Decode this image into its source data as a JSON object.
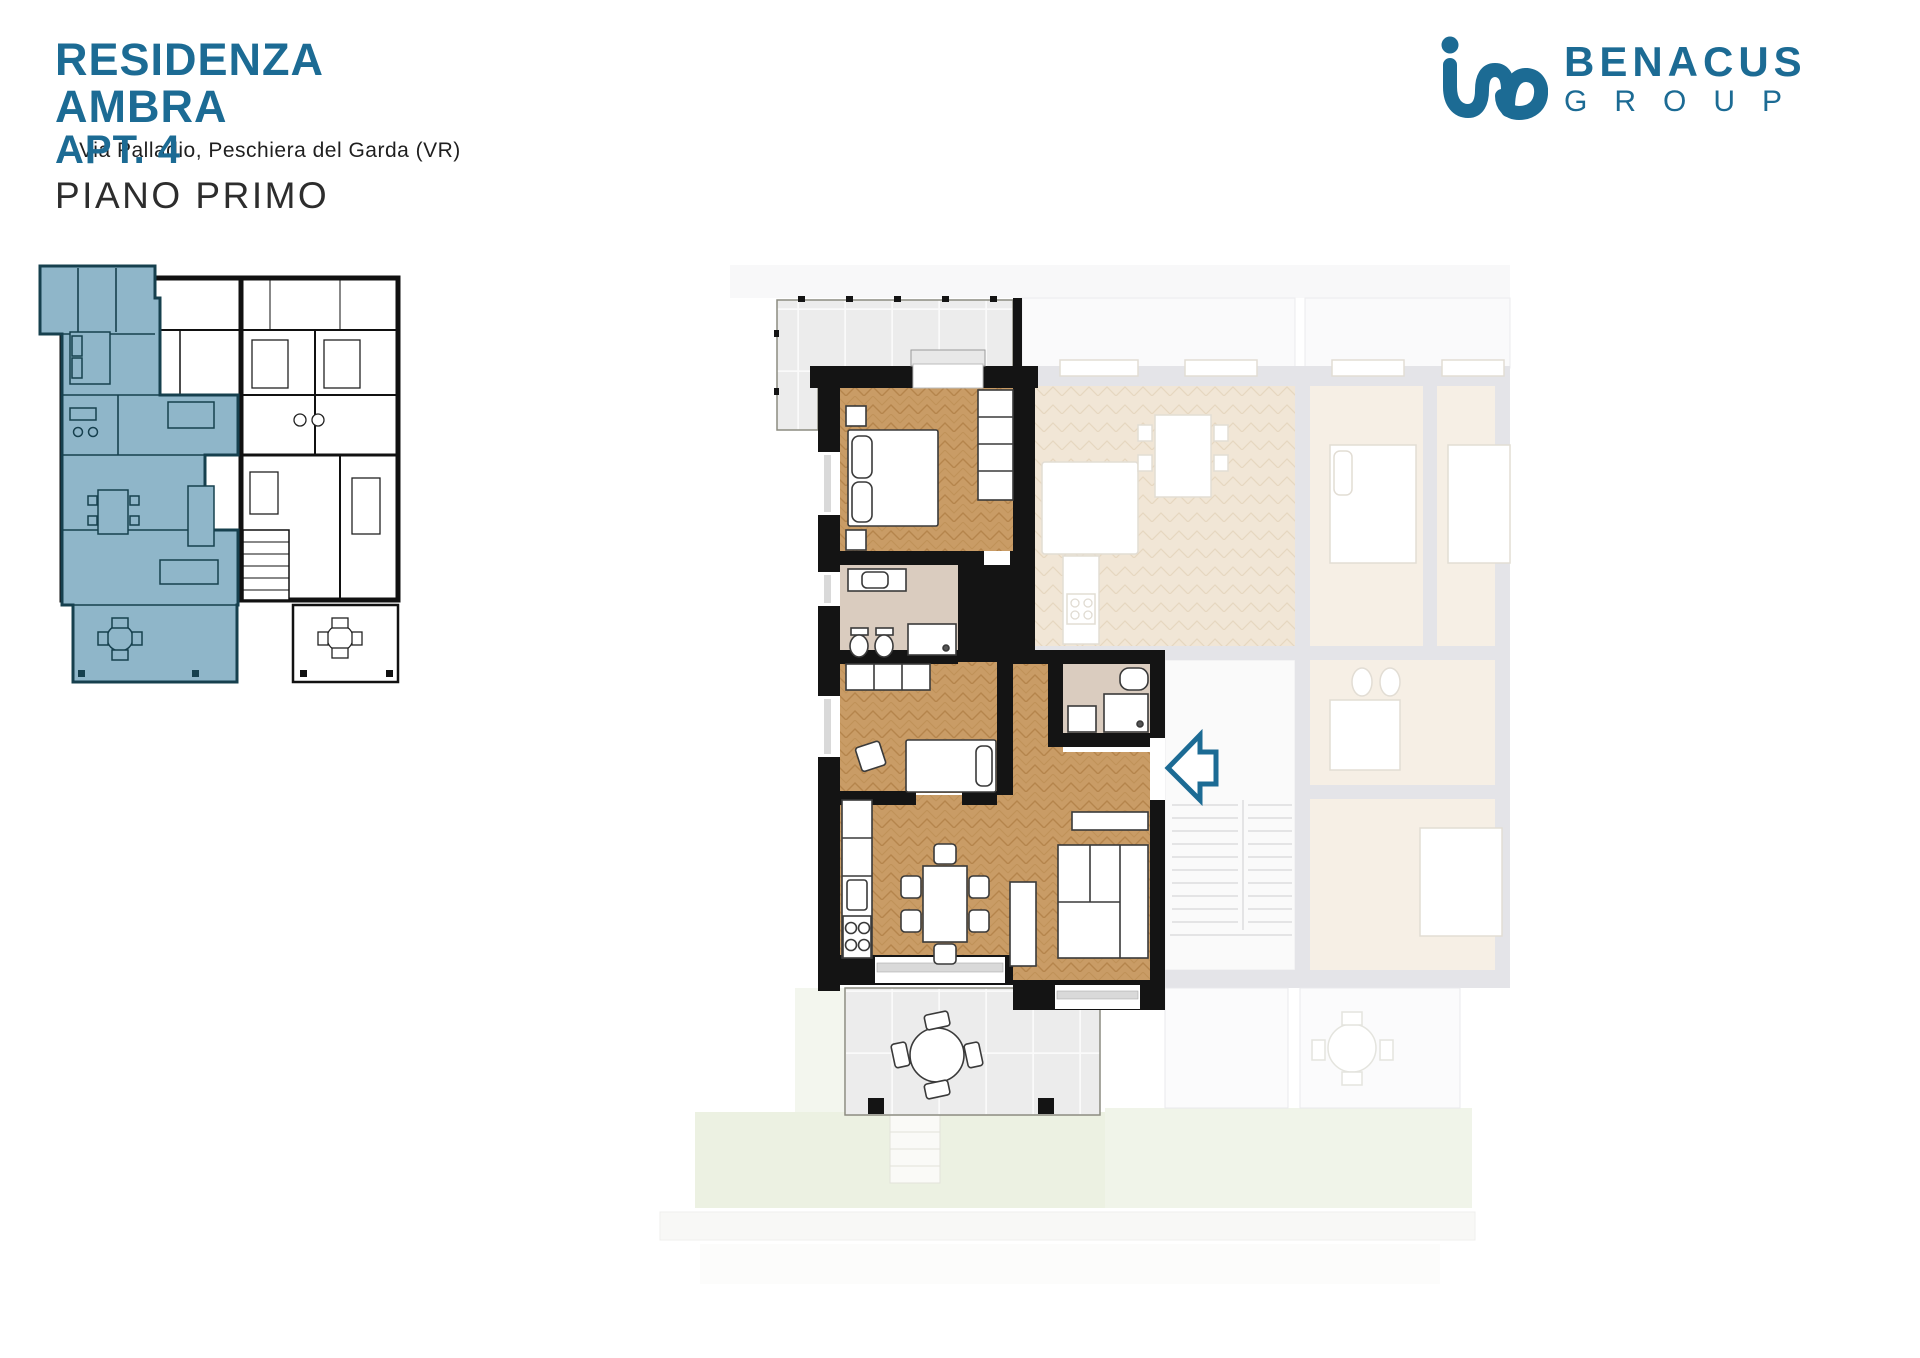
{
  "header": {
    "title": "RESIDENZA AMBRA",
    "subtitle": "Via Palladio, Peschiera del Garda (VR)",
    "apartment": "APT. 4",
    "floor": "PIANO PRIMO"
  },
  "logo": {
    "name": "BENACUS",
    "type": "GROUP",
    "mark_icon": "ino-monogram"
  },
  "icons": {
    "entrance": "left-arrow-outline"
  },
  "colors": {
    "accent": "#1c6b94",
    "highlight": "#8fb6c9",
    "highlight-line": "#16404e",
    "wall": "#141414",
    "wood": "#c99c66",
    "ghost": "#f6efe5",
    "ghost-wall": "#e4e4e8",
    "bath": "#daccbf",
    "terrace": "#ececec",
    "garden": "#ecf1e2",
    "sill": "#d9d9d9"
  }
}
